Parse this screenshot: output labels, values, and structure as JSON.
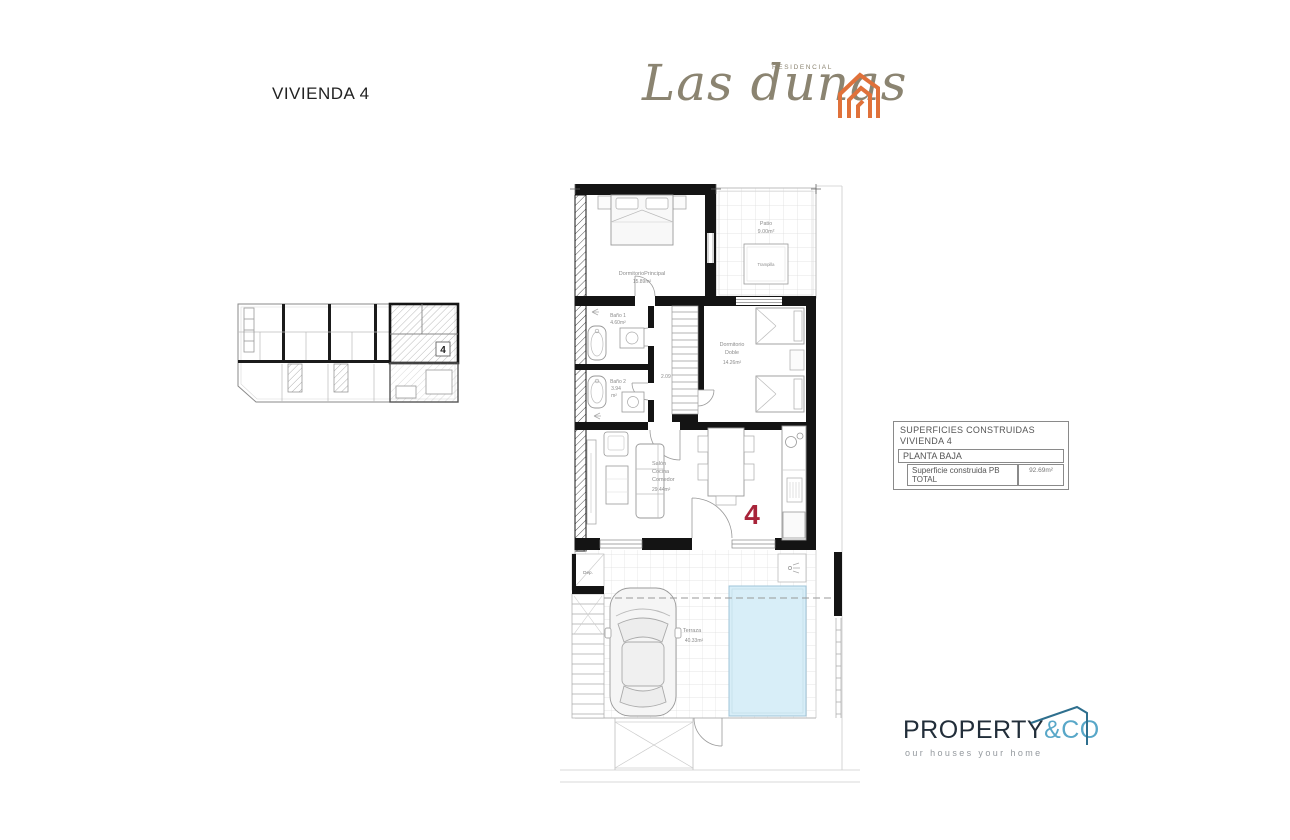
{
  "header": {
    "title": "VIVIENDA 4"
  },
  "brand": {
    "name": "Las dunas",
    "subtitle": "RESIDENCIAL",
    "icon_color": "#e0713a",
    "text_color": "#8b8471"
  },
  "site_plan": {
    "unit_number": "4"
  },
  "plan": {
    "dormitorio_principal": {
      "name": "DormitorioPrincipal",
      "area": "15.89m²"
    },
    "patio": {
      "name": "Patio",
      "area": "9.00m²",
      "trampilla": "Trampilla"
    },
    "bano1": {
      "name": "Baño 1",
      "area": "4.60m²"
    },
    "bano2": {
      "name": "Baño 2",
      "area_value": "3.94",
      "area_unit": "m²"
    },
    "dormitorio_doble": {
      "name_line1": "Dormitorio",
      "name_line2": "Doble",
      "area": "14.26m²"
    },
    "salon": {
      "name_line1": "Salón",
      "name_line2": "Cocina",
      "name_line3": "Comedor",
      "area": "29.44m²"
    },
    "terraza": {
      "name": "Terraza",
      "area": "40.33m²"
    },
    "dep": {
      "name": "Dep."
    },
    "corridor_width": "2.09",
    "unit_number": "4",
    "unit_number_color": "#a8243a",
    "pool_color": "#d8eef8"
  },
  "summary": {
    "title_line1": "SUPERFICIES CONSTRUIDAS",
    "title_line2": "VIVIENDA 4",
    "row_planta": "PLANTA BAJA",
    "row_total_label": "Superficie construida PB TOTAL",
    "row_total_value": "92.69m²"
  },
  "footer": {
    "brand_primary": "PROPERTY",
    "brand_secondary": "&CO",
    "tagline": "our houses your home",
    "primary_color": "#222e3a",
    "secondary_color": "#58a7c8"
  }
}
